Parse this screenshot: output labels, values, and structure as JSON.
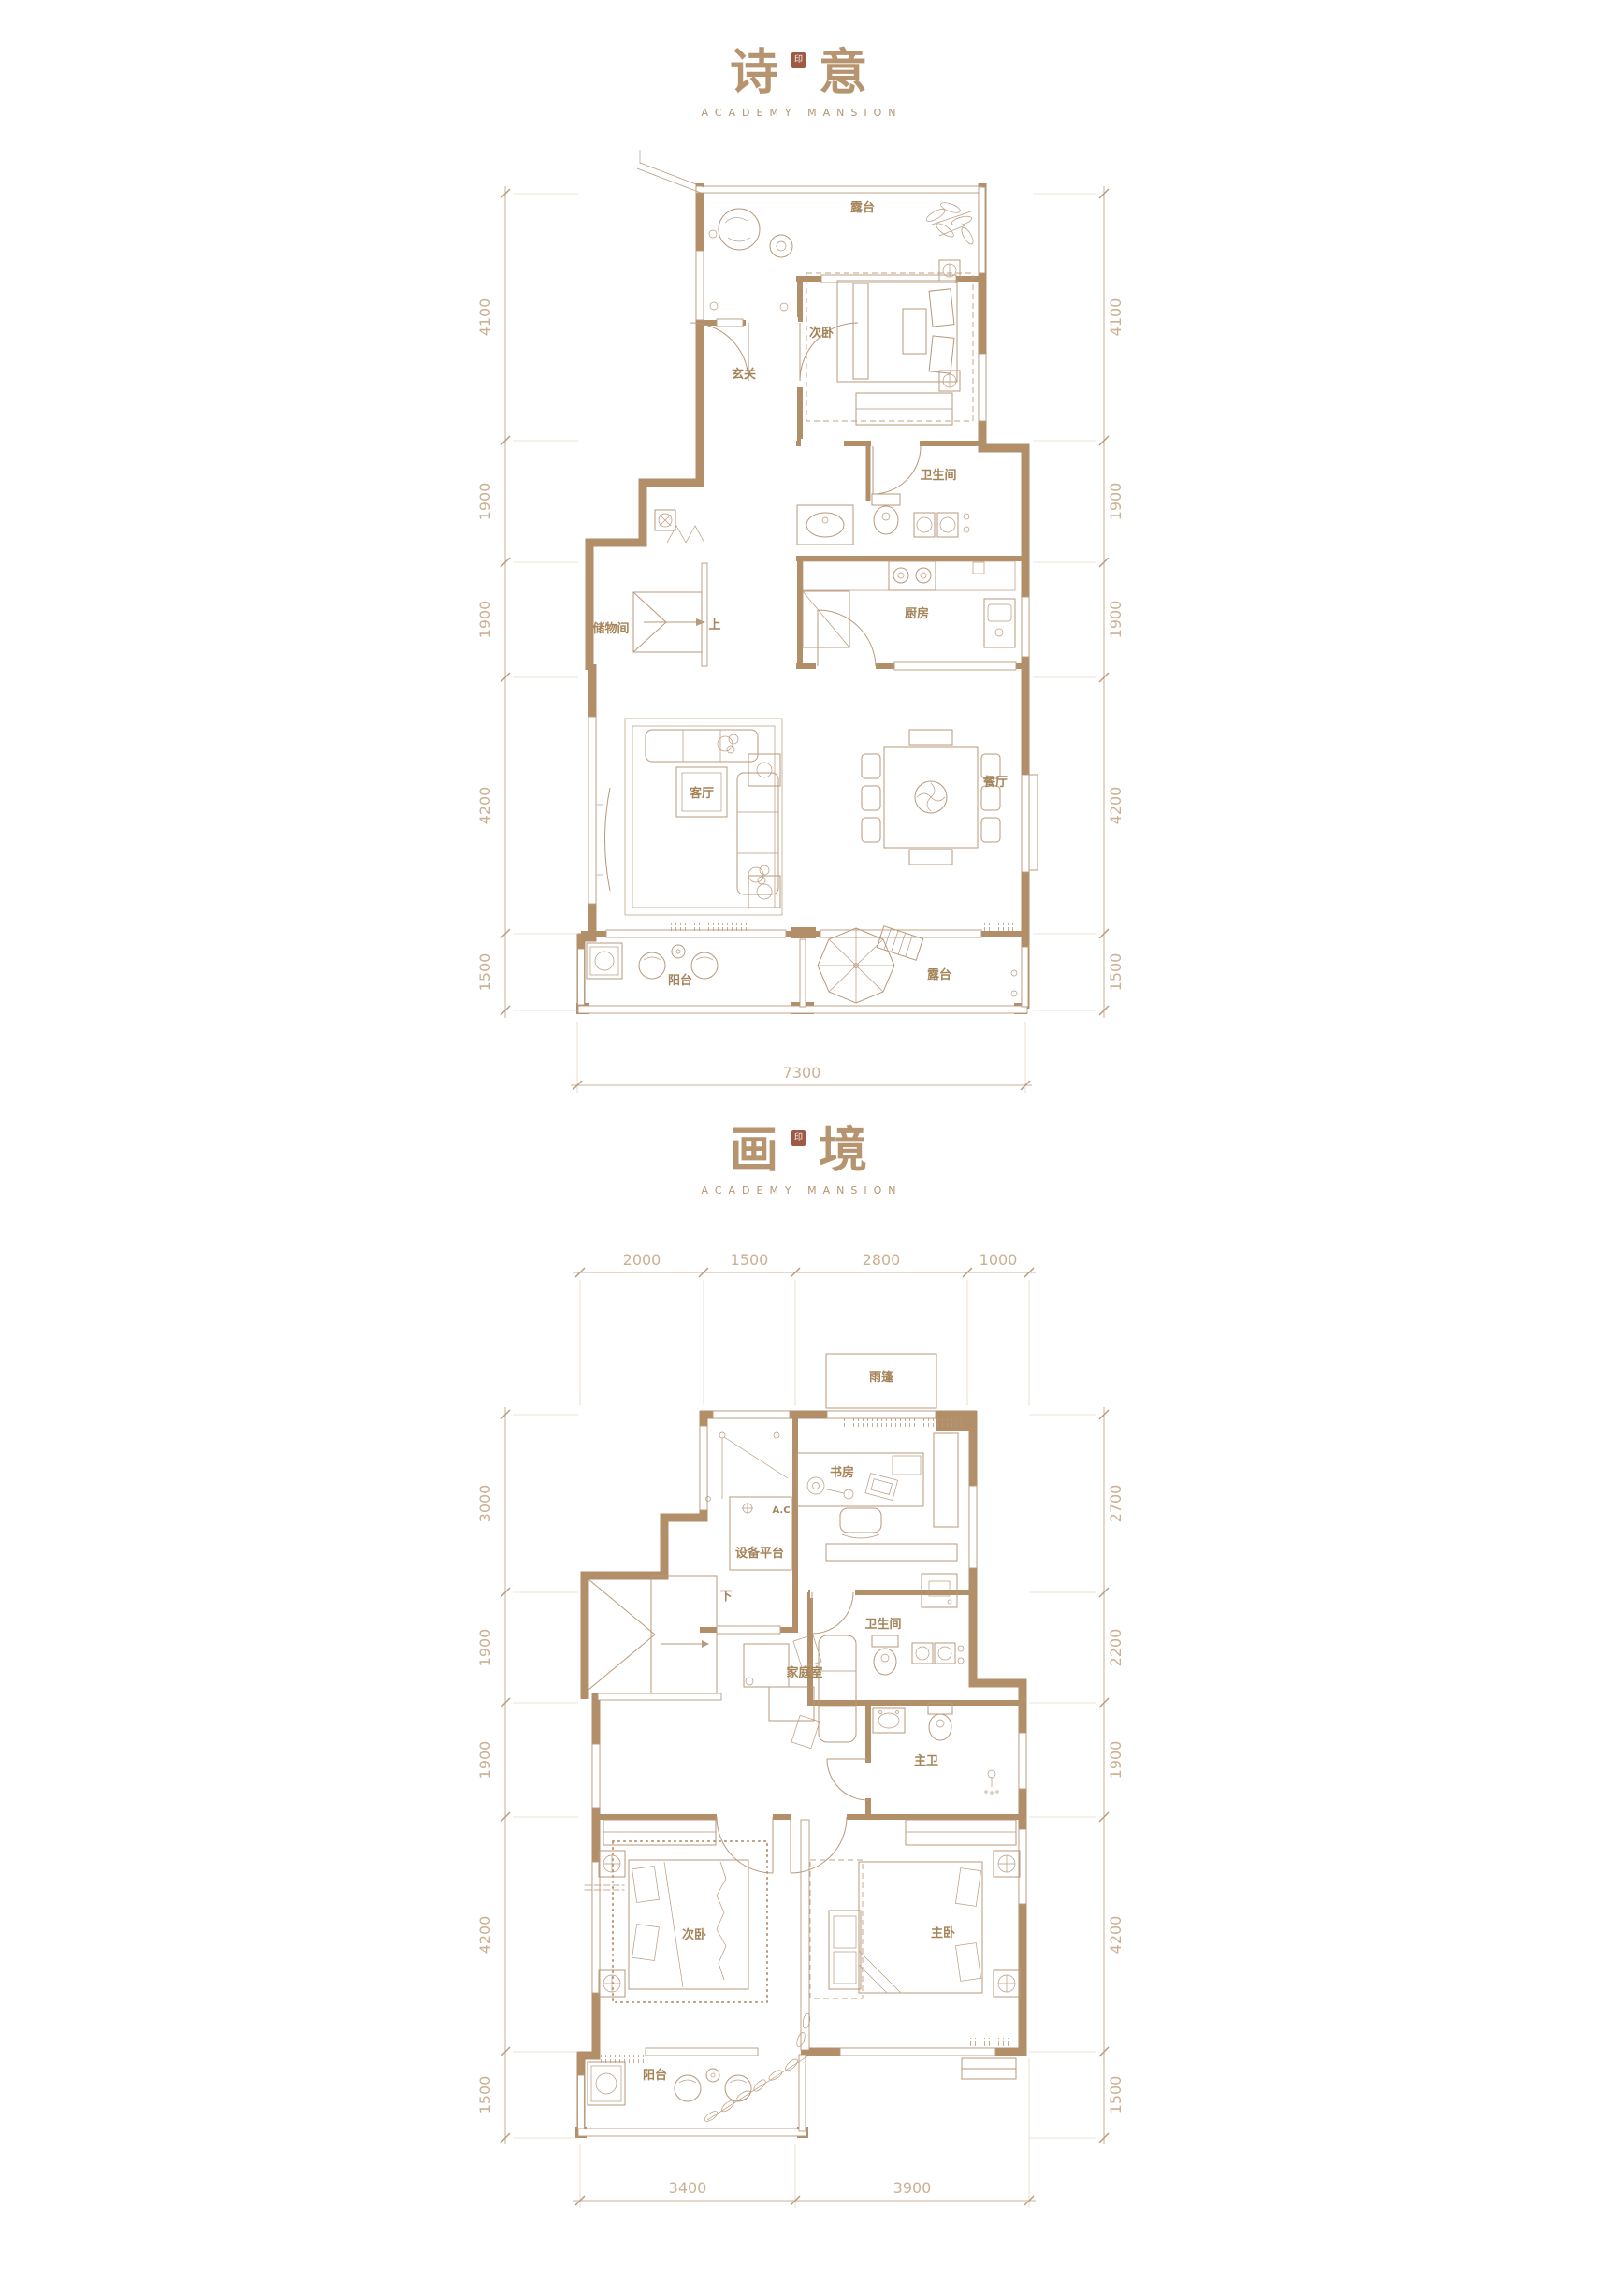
{
  "plan1": {
    "title": {
      "char1": "诗",
      "char2": "意",
      "seal": "印",
      "subtitle": "ACADEMY MANSION"
    },
    "rooms": {
      "terrace_top": "露台",
      "bedroom": "次卧",
      "entry": "玄关",
      "bath": "卫生间",
      "storage": "储物间",
      "stairs": "上",
      "kitchen": "厨房",
      "living": "客厅",
      "dining": "餐厅",
      "balcony": "阳台",
      "terrace_bottom": "露台"
    },
    "dims": {
      "left": [
        "4100",
        "1900",
        "1900",
        "4200",
        "1500"
      ],
      "right": [
        "4100",
        "1900",
        "1900",
        "4200",
        "1500"
      ],
      "bottom": [
        "7300"
      ]
    }
  },
  "plan2": {
    "title": {
      "char1": "画",
      "char2": "境",
      "seal": "印",
      "subtitle": "ACADEMY MANSION"
    },
    "rooms": {
      "canopy": "雨篷",
      "study": "书房",
      "equipment": "设备平台",
      "ac": "A.C",
      "bath": "卫生间",
      "family": "家庭室",
      "master_bath": "主卫",
      "stairs": "下",
      "bedroom": "次卧",
      "master": "主卧",
      "balcony": "阳台"
    },
    "dims": {
      "top": [
        "2000",
        "1500",
        "2800",
        "1000"
      ],
      "left": [
        "3000",
        "1900",
        "1900",
        "4200",
        "1500"
      ],
      "right": [
        "2700",
        "2200",
        "1900",
        "4200",
        "1500"
      ],
      "bottom": [
        "3400",
        "3900"
      ]
    }
  }
}
